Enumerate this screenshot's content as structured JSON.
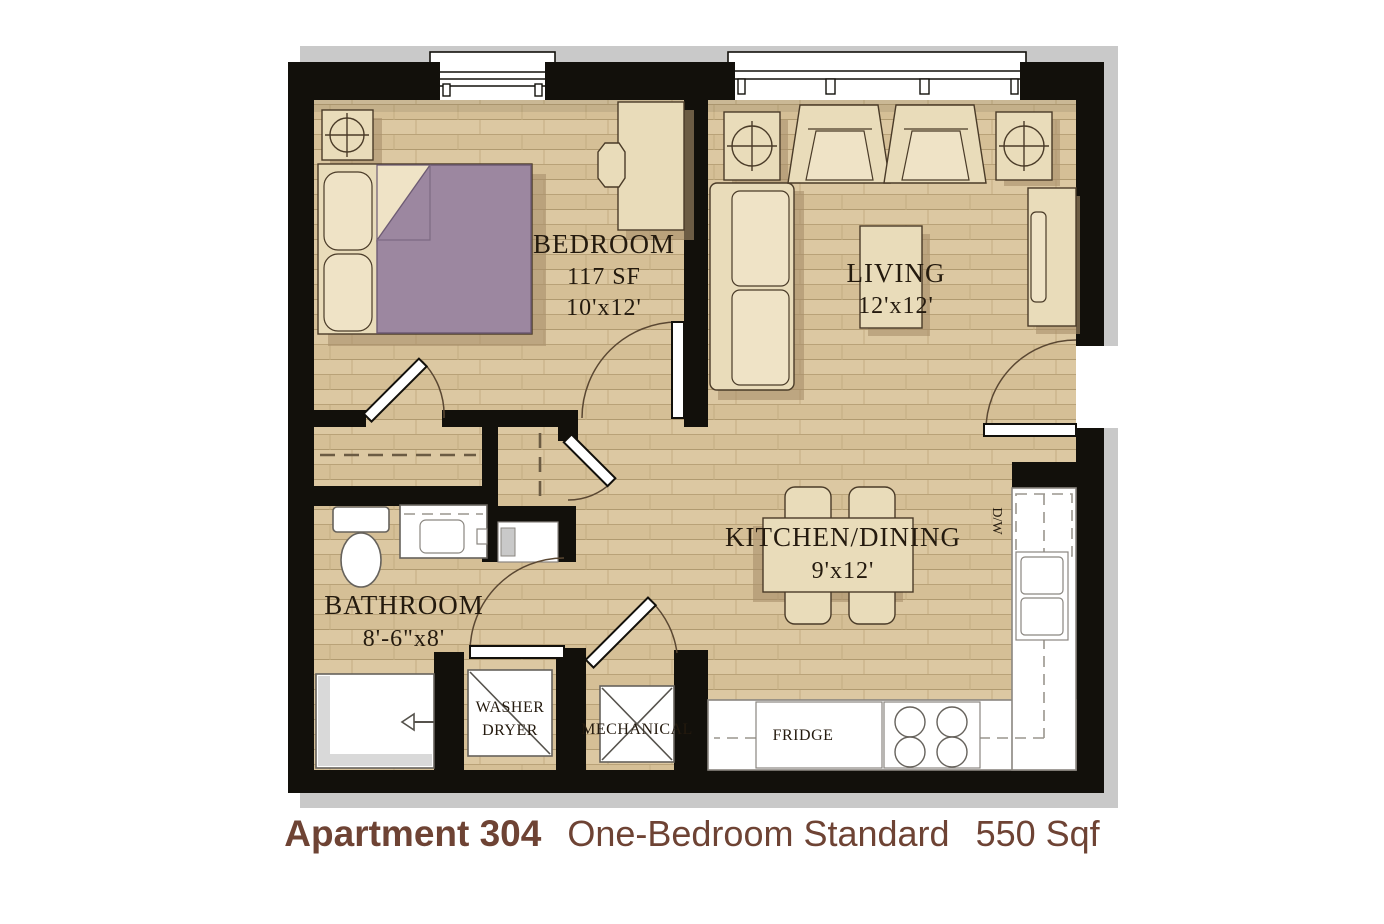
{
  "plan": {
    "rooms": {
      "bedroom": {
        "name": "BEDROOM",
        "area": "117 SF",
        "dims": "10'x12'"
      },
      "living": {
        "name": "LIVING",
        "dims": "12'x12'"
      },
      "kitchen": {
        "name": "KITCHEN/DINING",
        "dims": "9'x12'"
      },
      "bathroom": {
        "name": "BATHROOM",
        "dims": "8'-6\"x8'"
      }
    },
    "labels": {
      "washer_line1": "WASHER",
      "washer_line2": "DRYER",
      "mechanical": "MECHANICAL",
      "fridge": "FRIDGE",
      "dishwasher": "D/W"
    },
    "colors": {
      "wall_black": "#12100b",
      "floor_wood": "#d8c29a",
      "furniture_tan": "#e9dcba",
      "bed_blanket_mauve": "#9c87a0",
      "shadow_gray": "#c9c9c9",
      "caption_brown": "#6e4334"
    }
  },
  "caption": {
    "unit": "Apartment 304",
    "type": "One-Bedroom Standard",
    "area": "550 Sqf"
  }
}
